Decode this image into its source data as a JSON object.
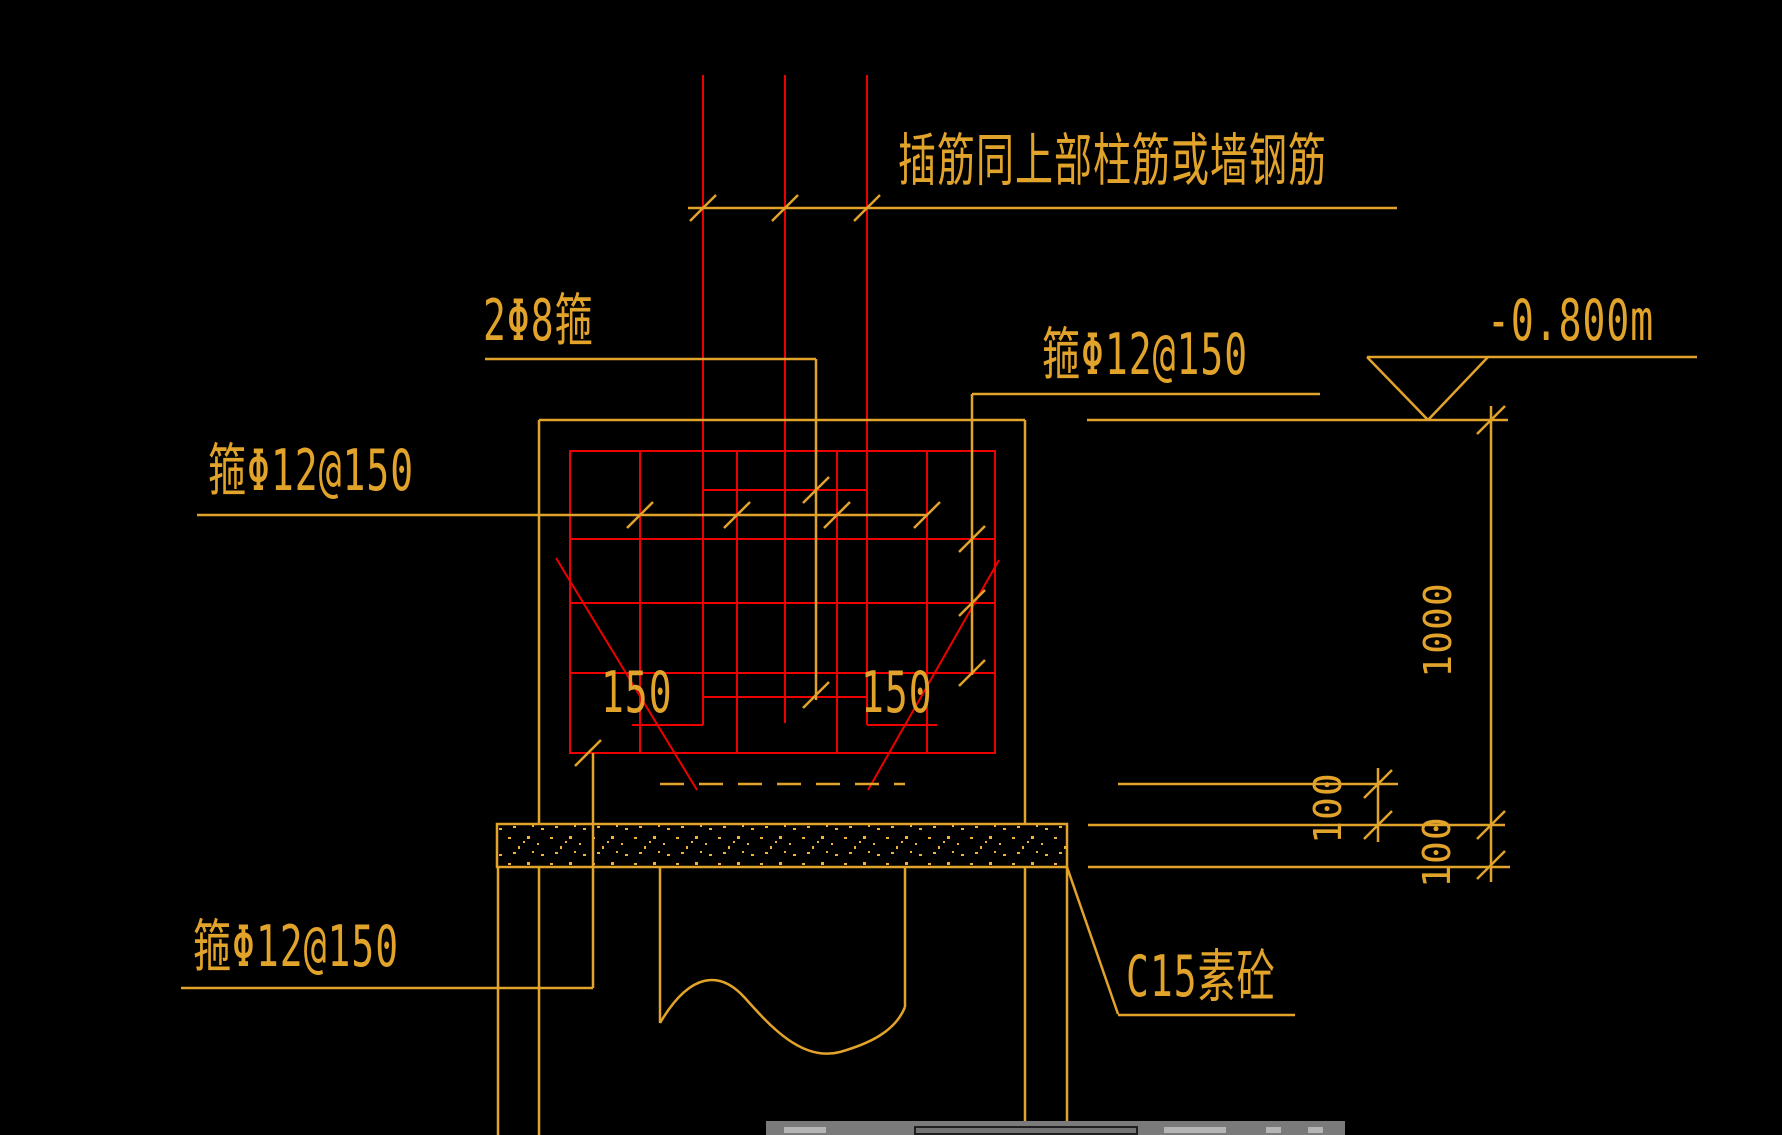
{
  "app": {
    "view": "cad-drawing-canvas"
  },
  "colors": {
    "background": "#000000",
    "annotation_yellow": "#E2A32B",
    "rebar_red": "#EE0000",
    "speckle": "#F2B236",
    "ui_bar_grey": "#7A7A7A"
  },
  "annotations": {
    "dowel_note": "插筋同上部柱筋或墙钢筋",
    "tie_2phi8": "2Φ8箍",
    "stirrup_top_right": "箍Φ12@150",
    "stirrup_left": "箍Φ12@150",
    "stirrup_bottom_left": "箍Φ12@150",
    "cushion_material": "C15素砼",
    "elevation_mark": "-0.800m"
  },
  "dimensions": {
    "footing_height": "1000",
    "pile_embed_offset": "100",
    "cushion_thickness": "100",
    "stirrup_spacing_left": "150",
    "stirrup_spacing_right": "150"
  }
}
